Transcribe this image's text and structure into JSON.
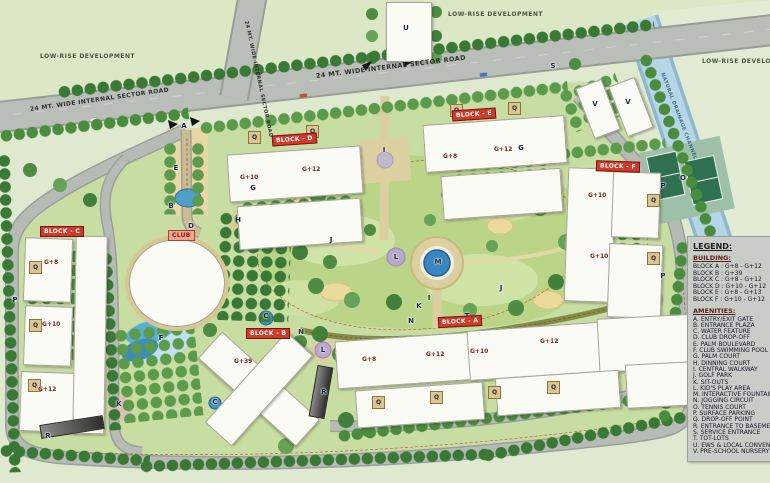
{
  "map": {
    "surroundings": {
      "low_rise_left": "LOW-RISE DEVELOPMENT",
      "low_rise_top": "LOW-RISE DEVELOPMENT",
      "low_rise_right": "LOW-RISE DEVELOPMENT"
    },
    "roads": {
      "sector_road_left": "24 MT. WIDE INTERNAL SECTOR ROAD",
      "sector_road_center": "24 MT. WIDE INTERNAL SECTOR ROAD",
      "sector_road_vertical": "24 MT. WIDE INTERNAL SECTOR ROAD"
    },
    "canal_label": "NATURAL DRAINAGE CHANNEL",
    "badges": {
      "block_a": "BLOCK - A",
      "block_b": "BLOCK - B",
      "block_c": "BLOCK - C",
      "block_d": "BLOCK - D",
      "block_e": "BLOCK - E",
      "block_f": "BLOCK - F",
      "club": "CLUB"
    },
    "markers": [
      {
        "letter": "A",
        "pos": "left:179px;top:121px"
      },
      {
        "letter": "S",
        "pos": "left:548px;top:61px"
      },
      {
        "letter": "U",
        "pos": "left:401px;top:23px"
      },
      {
        "letter": "V",
        "pos": "left:590px;top:99px"
      },
      {
        "letter": "V",
        "pos": "left:623px;top:97px"
      },
      {
        "letter": "B",
        "pos": "left:166px;top:201px"
      },
      {
        "letter": "E",
        "pos": "left:171px;top:163px"
      },
      {
        "letter": "D",
        "pos": "left:186px;top:221px"
      },
      {
        "letter": "F",
        "pos": "left:156px;top:333px"
      },
      {
        "letter": "C",
        "pos": "left:261px;top:311px"
      },
      {
        "letter": "C",
        "pos": "left:210px;top:397px"
      },
      {
        "letter": "G",
        "pos": "left:248px;top:183px"
      },
      {
        "letter": "G",
        "pos": "left:516px;top:143px"
      },
      {
        "letter": "H",
        "pos": "left:233px;top:215px"
      },
      {
        "letter": "I",
        "pos": "left:379px;top:145px"
      },
      {
        "letter": "I",
        "pos": "left:424px;top:293px"
      },
      {
        "letter": "J",
        "pos": "left:326px;top:235px"
      },
      {
        "letter": "J",
        "pos": "left:496px;top:283px"
      },
      {
        "letter": "K",
        "pos": "left:414px;top:301px"
      },
      {
        "letter": "K",
        "pos": "left:114px;top:399px"
      },
      {
        "letter": "L",
        "pos": "left:391px;top:252px"
      },
      {
        "letter": "L",
        "pos": "left:318px;top:345px"
      },
      {
        "letter": "M",
        "pos": "left:433px;top:257px"
      },
      {
        "letter": "N",
        "pos": "left:406px;top:316px"
      },
      {
        "letter": "N",
        "pos": "left:296px;top:327px"
      },
      {
        "letter": "O",
        "pos": "left:678px;top:173px"
      },
      {
        "letter": "P",
        "pos": "left:658px;top:181px"
      },
      {
        "letter": "P",
        "pos": "left:658px;top:271px"
      },
      {
        "letter": "P",
        "pos": "left:10px;top:295px"
      },
      {
        "letter": "R",
        "pos": "left:43px;top:431px"
      },
      {
        "letter": "R",
        "pos": "left:319px;top:387px"
      },
      {
        "letter": "T",
        "pos": "left:462px;top:311px"
      }
    ],
    "qpads": [
      {
        "letter": "Q",
        "pos": "left:29px;top:261px"
      },
      {
        "letter": "Q",
        "pos": "left:29px;top:319px"
      },
      {
        "letter": "Q",
        "pos": "left:28px;top:379px"
      },
      {
        "letter": "Q",
        "pos": "left:248px;top:131px"
      },
      {
        "letter": "Q",
        "pos": "left:306px;top:125px"
      },
      {
        "letter": "Q",
        "pos": "left:450px;top:104px"
      },
      {
        "letter": "Q",
        "pos": "left:508px;top:102px"
      },
      {
        "letter": "Q",
        "pos": "left:647px;top:194px"
      },
      {
        "letter": "Q",
        "pos": "left:647px;top:252px"
      },
      {
        "letter": "Q",
        "pos": "left:372px;top:396px"
      },
      {
        "letter": "Q",
        "pos": "left:430px;top:391px"
      },
      {
        "letter": "Q",
        "pos": "left:488px;top:386px"
      },
      {
        "letter": "Q",
        "pos": "left:547px;top:381px"
      }
    ],
    "heights": [
      {
        "label": "G+8",
        "pos": "left:44px;top:259px"
      },
      {
        "label": "G+10",
        "pos": "left:42px;top:321px"
      },
      {
        "label": "G+12",
        "pos": "left:38px;top:386px"
      },
      {
        "label": "G+10",
        "pos": "left:240px;top:174px"
      },
      {
        "label": "G+12",
        "pos": "left:302px;top:166px"
      },
      {
        "label": "G+8",
        "pos": "left:443px;top:153px"
      },
      {
        "label": "G+12",
        "pos": "left:494px;top:146px"
      },
      {
        "label": "G+10",
        "pos": "left:588px;top:192px"
      },
      {
        "label": "G+10",
        "pos": "left:590px;top:253px"
      },
      {
        "label": "G+8",
        "pos": "left:362px;top:356px"
      },
      {
        "label": "G+12",
        "pos": "left:426px;top:351px"
      },
      {
        "label": "G+10",
        "pos": "left:470px;top:348px"
      },
      {
        "label": "G+12",
        "pos": "left:540px;top:338px"
      },
      {
        "label": "G+39",
        "pos": "left:234px;top:358px"
      }
    ]
  },
  "legend": {
    "title": "LEGEND:",
    "building_heading": "BUILDING:",
    "buildings": [
      "BLOCK A : G+8 - G+12",
      "BLOCK B : G+39",
      "BLOCK C : G+8 - G+12",
      "BLOCK D : G+10 - G+12",
      "BLOCK E : G+8 - G+13",
      "BLOCK F : G+10 - G+12"
    ],
    "amenities_heading": "AMENITIES:",
    "amenities": [
      "A. ENTRY/EXIT GATE",
      "B. ENTRANCE PLAZA",
      "C. WATER FEATURE",
      "D. CLUB DROP-OFF",
      "E. PALM BOULEVARD",
      "F. CLUB SWIMMING POOL",
      "G. PALM COURT",
      "H. DINNING COURT",
      "I. CENTRAL WALKWAY",
      "J. GOLF PARK",
      "K. SIT-OUTS",
      "L. KID'S PLAY AREA",
      "M. INTERACTIVE FOUNTAIN",
      "N. JOGGING CIRCUIT",
      "O. TENNIS COURT",
      "P. SURFACE PARKING",
      "Q. DROP-OFF POINT",
      "R. ENTRANCE TO BASEMENT",
      "S. SERVICE ENTRANCE",
      "T. TOT-LOTS",
      "U. EWS & LOCAL CONVENIENCE",
      "V. PRE-SCHOOL NURSERY"
    ]
  }
}
